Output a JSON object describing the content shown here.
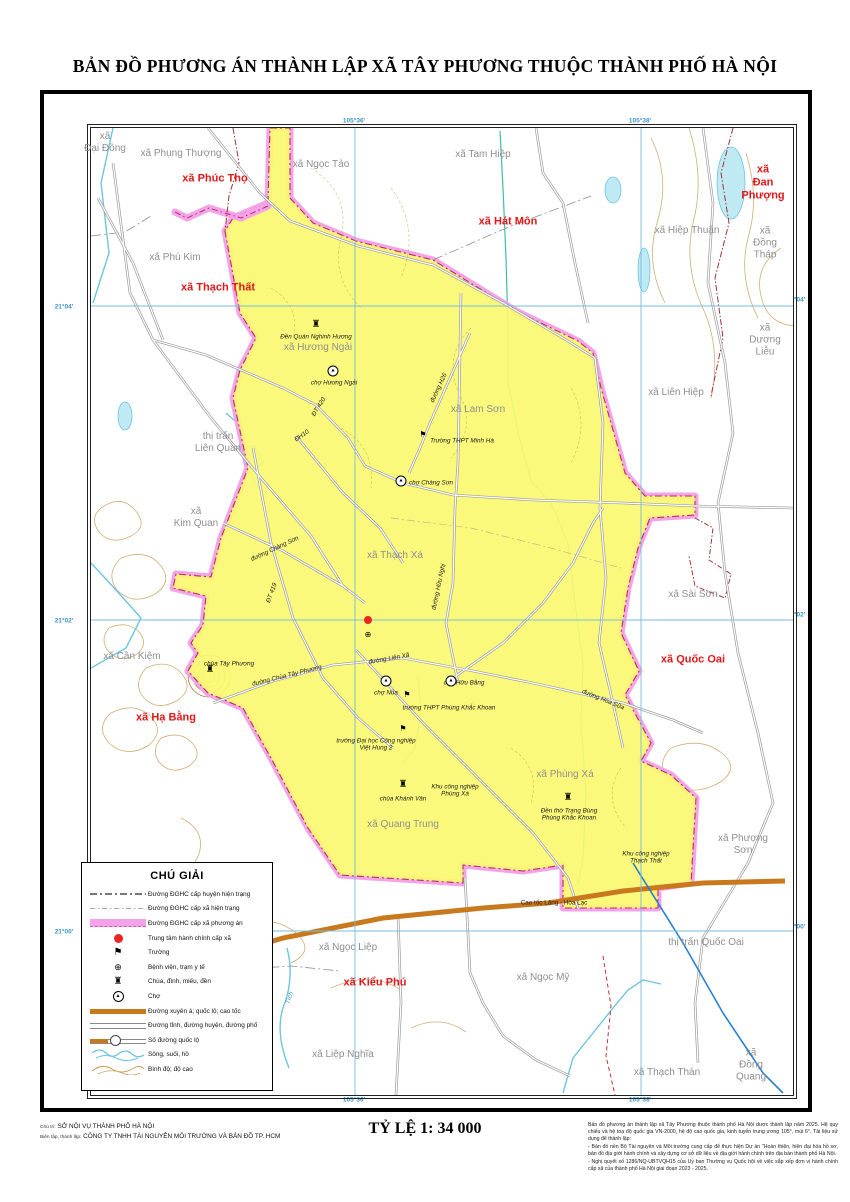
{
  "title": "BẢN ĐỒ PHƯƠNG ÁN THÀNH LẬP XÃ TÂY PHƯƠNG THUỘC THÀNH PHỐ HÀ NỘI",
  "scale_text": "TỶ LỆ 1: 34 000",
  "coords": {
    "lon1": "105°36'",
    "lon2": "105°38'",
    "lat1": "21°04'",
    "lat2": "21°02'",
    "lat3": "21°00'"
  },
  "legend": {
    "title": "CHÚ GIẢI",
    "items": [
      {
        "symbol": "boundary-district-line",
        "label": "Đường ĐGHC cấp huyện hiện trạng"
      },
      {
        "symbol": "boundary-commune-line",
        "label": "Đường ĐGHC cấp xã hiện trạng"
      },
      {
        "symbol": "boundary-proposed-band",
        "label": "Đường ĐGHC cấp xã phương án"
      },
      {
        "symbol": "commune-center-dot",
        "label": "Trung tâm hành chính cấp xã"
      },
      {
        "symbol": "school-flag",
        "label": "Trường"
      },
      {
        "symbol": "hospital-cross",
        "label": "Bệnh viện, trạm y tế"
      },
      {
        "symbol": "pagoda",
        "label": "Chùa, đình, miếu, đền"
      },
      {
        "symbol": "market",
        "label": "Chợ"
      },
      {
        "symbol": "expressway-band",
        "label": "Đường xuyên á; quốc lộ; cao tốc"
      },
      {
        "symbol": "road-double-line",
        "label": "Đường tỉnh, đường huyện, đường phố"
      },
      {
        "symbol": "route-number",
        "label": "Số đường quốc lộ"
      },
      {
        "symbol": "water-lines",
        "label": "Sông, suối, hồ"
      },
      {
        "symbol": "contour-lines",
        "label": "Bình độ; độ cao"
      }
    ]
  },
  "credits": {
    "role1": "Chủ trì:",
    "org1": "SỞ NỘI VỤ THÀNH PHỐ HÀ NỘI",
    "role2": "Biên tập, thành lập:",
    "org2": "CÔNG TY TNHH TÀI NGUYÊN MÔI TRƯỜNG VÀ BẢN ĐỒ TP. HCM"
  },
  "notes": [
    "Bản đồ phương án thành lập xã Tây Phương thuộc thành phố Hà Nội được thành lập năm 2025. Hệ quy chiếu và hệ toạ độ quốc gia VN-2000, hệ độ cao quốc gia, kinh tuyến trung ương 105°, múi 6°. Tài liệu sử dụng để thành lập:",
    "- Bản đồ nền Bộ Tài nguyên và Môi trường cung cấp để thực hiện Dự án \"Hoàn thiện, hiện đại hóa hồ sơ, bản đồ địa giới hành chính và xây dựng cơ sở dữ liệu về địa giới hành chính trên địa bàn thành phố Hà Nội.",
    "- Nghị quyết số 1286/NQ-UBTVQH15 của Uỷ ban Thường vụ Quốc hội về việc sắp xếp đơn vị hành chính cấp xã của thành phố Hà Nội giai đoạn 2023 - 2025."
  ],
  "map": {
    "colors": {
      "proposed_area_fill": "#fbf870",
      "proposed_boundary": "#f5a3e9",
      "expressway": "#c8791e",
      "grid": "#74bede",
      "water": "#6cc6e0",
      "red_label": "#e01818",
      "gray_label": "#8f8f8f"
    },
    "labels": [
      {
        "t": "xã Phúc Thọ",
        "x": 124,
        "y": 51,
        "c": "red"
      },
      {
        "t": "xã Thạch Thất",
        "x": 127,
        "y": 160,
        "c": "red"
      },
      {
        "t": "xã Hát Môn",
        "x": 417,
        "y": 94,
        "c": "red"
      },
      {
        "t": "xã\nĐan\nPhượng",
        "x": 672,
        "y": 55,
        "c": "red"
      },
      {
        "t": "xã Quốc Oai",
        "x": 602,
        "y": 532,
        "c": "red"
      },
      {
        "t": "xã Hạ Bằng",
        "x": 75,
        "y": 590,
        "c": "red"
      },
      {
        "t": "xã Kiểu Phú",
        "x": 284,
        "y": 855,
        "c": "red"
      },
      {
        "t": "xã\nĐại Đồng",
        "x": 14,
        "y": 15,
        "c": "comm"
      },
      {
        "t": "xã Phụng Thượng",
        "x": 90,
        "y": 26,
        "c": "comm"
      },
      {
        "t": "xã Ngọc Tảo",
        "x": 230,
        "y": 37,
        "c": "comm"
      },
      {
        "t": "xã Phú Kim",
        "x": 84,
        "y": 130,
        "c": "comm"
      },
      {
        "t": "xã Tam Hiệp",
        "x": 392,
        "y": 27,
        "c": "comm"
      },
      {
        "t": "xã Hiệp Thuận",
        "x": 596,
        "y": 103,
        "c": "comm"
      },
      {
        "t": "xã\nĐồng\nTháp",
        "x": 674,
        "y": 115,
        "c": "comm"
      },
      {
        "t": "xã\nDương\nLiễu",
        "x": 674,
        "y": 212,
        "c": "comm"
      },
      {
        "t": "xã Liên Hiệp",
        "x": 585,
        "y": 265,
        "c": "comm"
      },
      {
        "t": "xã Sài Sơn",
        "x": 602,
        "y": 467,
        "c": "comm"
      },
      {
        "t": "xã Hương Ngải",
        "x": 227,
        "y": 220,
        "c": "comm"
      },
      {
        "t": "xã Lam Sơn",
        "x": 387,
        "y": 282,
        "c": "comm"
      },
      {
        "t": "thị trấn\nLiên Quan",
        "x": 127,
        "y": 315,
        "c": "comm"
      },
      {
        "t": "xã\nKim Quan",
        "x": 105,
        "y": 390,
        "c": "comm"
      },
      {
        "t": "xã Cần Kiệm",
        "x": 41,
        "y": 529,
        "c": "comm"
      },
      {
        "t": "xã Thạch Xá",
        "x": 304,
        "y": 428,
        "c": "comm"
      },
      {
        "t": "xã Phùng Xá",
        "x": 474,
        "y": 647,
        "c": "comm"
      },
      {
        "t": "xã Quang Trung",
        "x": 312,
        "y": 697,
        "c": "comm"
      },
      {
        "t": "xã Phượng Sơn",
        "x": 652,
        "y": 717,
        "c": "comm"
      },
      {
        "t": "thị trấn Quốc Oai",
        "x": 615,
        "y": 815,
        "c": "comm"
      },
      {
        "t": "xã Ngọc Liệp",
        "x": 257,
        "y": 820,
        "c": "comm"
      },
      {
        "t": "xã Ngọc Mỹ",
        "x": 452,
        "y": 850,
        "c": "comm"
      },
      {
        "t": "xã Liệp Nghĩa",
        "x": 252,
        "y": 927,
        "c": "comm"
      },
      {
        "t": "xã Thạch Thán",
        "x": 576,
        "y": 945,
        "c": "comm"
      },
      {
        "t": "xã\nĐồng Quang",
        "x": 660,
        "y": 937,
        "c": "comm"
      },
      {
        "t": "Đền Quán Nghinh Hương",
        "x": 225,
        "y": 209,
        "c": "poi-i"
      },
      {
        "t": "chợ Hương Ngải",
        "x": 243,
        "y": 255,
        "c": "poi-i"
      },
      {
        "t": "Trường THPT Minh Hà",
        "x": 371,
        "y": 313,
        "c": "poi-i"
      },
      {
        "t": "chợ Chàng Sơn",
        "x": 340,
        "y": 355,
        "c": "poi-i"
      },
      {
        "t": "chợ Nủa",
        "x": 295,
        "y": 565,
        "c": "poi-i"
      },
      {
        "t": "chợ Hữu Bằng",
        "x": 373,
        "y": 555,
        "c": "poi-i"
      },
      {
        "t": "trường THPT Phùng Khắc Khoan",
        "x": 358,
        "y": 580,
        "c": "poi-i"
      },
      {
        "t": "trường Đại học Công nghiệp\nViệt Hung 2",
        "x": 285,
        "y": 617,
        "c": "poi-i"
      },
      {
        "t": "chùa Tây Phương",
        "x": 138,
        "y": 536,
        "c": "poi-i"
      },
      {
        "t": "chùa Khánh Vân",
        "x": 312,
        "y": 671,
        "c": "poi-i"
      },
      {
        "t": "Khu công nghiệp\nPhùng Xá",
        "x": 364,
        "y": 663,
        "c": "poi-i"
      },
      {
        "t": "Đền thờ Trạng Bùng\nPhùng Khắc Khoan",
        "x": 478,
        "y": 687,
        "c": "poi-i"
      },
      {
        "t": "Khu công nghiệp\nThạch Thất",
        "x": 555,
        "y": 730,
        "c": "poi-i"
      },
      {
        "t": "Cao tốc Láng - Hòa Lạc",
        "x": 463,
        "y": 775,
        "c": "poi"
      },
      {
        "t": "Tích",
        "x": 199,
        "y": 870,
        "c": "blue-i",
        "r": -70
      },
      {
        "t": "ĐT 420",
        "x": 228,
        "y": 279,
        "c": "road",
        "r": -58
      },
      {
        "t": "ĐH10",
        "x": 211,
        "y": 308,
        "c": "road",
        "r": -35
      },
      {
        "t": "ĐT 419",
        "x": 181,
        "y": 465,
        "c": "road",
        "r": -70
      },
      {
        "t": "đường Chàng Sơn",
        "x": 184,
        "y": 421,
        "c": "road",
        "r": -25
      },
      {
        "t": "đường Hữu Nghị",
        "x": 348,
        "y": 459,
        "c": "road",
        "r": -78
      },
      {
        "t": "đường H26",
        "x": 348,
        "y": 260,
        "c": "road",
        "r": -65
      },
      {
        "t": "đường Liên Xã",
        "x": 298,
        "y": 531,
        "c": "road",
        "r": -10
      },
      {
        "t": "đường Chùa Tây Phương",
        "x": 196,
        "y": 548,
        "c": "road",
        "r": -14
      },
      {
        "t": "đường Hoa Sữa",
        "x": 512,
        "y": 572,
        "c": "road",
        "r": 22
      }
    ],
    "symbols": [
      {
        "k": "temple",
        "x": 225,
        "y": 197
      },
      {
        "k": "temple",
        "x": 119,
        "y": 542
      },
      {
        "k": "temple",
        "x": 312,
        "y": 657
      },
      {
        "k": "temple",
        "x": 477,
        "y": 670
      },
      {
        "k": "market",
        "x": 242,
        "y": 243
      },
      {
        "k": "market",
        "x": 310,
        "y": 353
      },
      {
        "k": "market",
        "x": 295,
        "y": 553
      },
      {
        "k": "market",
        "x": 360,
        "y": 553
      },
      {
        "k": "school",
        "x": 332,
        "y": 307
      },
      {
        "k": "school",
        "x": 316,
        "y": 567
      },
      {
        "k": "school",
        "x": 312,
        "y": 601
      },
      {
        "k": "hospital",
        "x": 277,
        "y": 507
      },
      {
        "k": "center",
        "x": 277,
        "y": 492
      }
    ]
  }
}
